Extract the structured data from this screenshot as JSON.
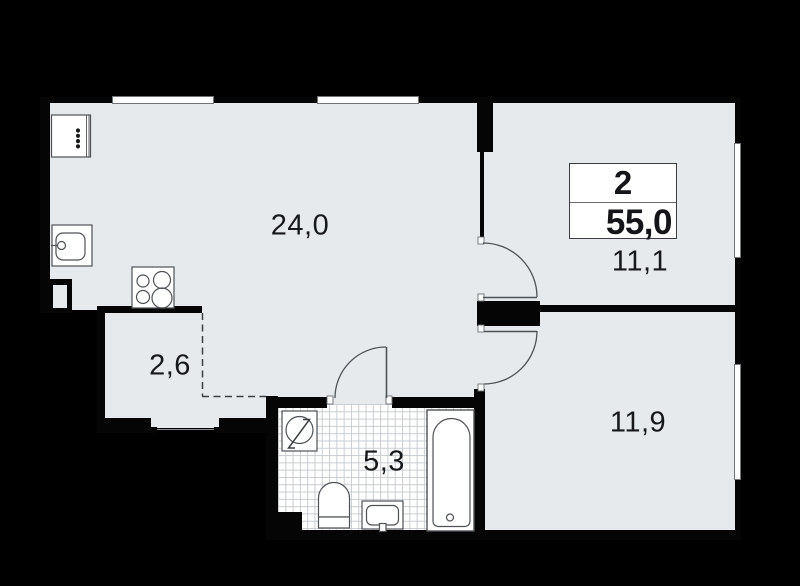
{
  "floorplan": {
    "info_box": {
      "rooms_count": "2",
      "total_area": "55,0"
    },
    "room_labels": {
      "living_kitchen": "24,0",
      "bedroom_top": "11,1",
      "bedroom_bottom": "11,9",
      "hallway": "2,6",
      "bathroom": "5,3"
    },
    "colors": {
      "background": "#000000",
      "floor": "#e7eaed",
      "wall": "#050505",
      "fixture_fill": "#ffffff",
      "outline": "#4e5256",
      "tile_line": "#c8cdd1",
      "text": "#17181a"
    }
  }
}
